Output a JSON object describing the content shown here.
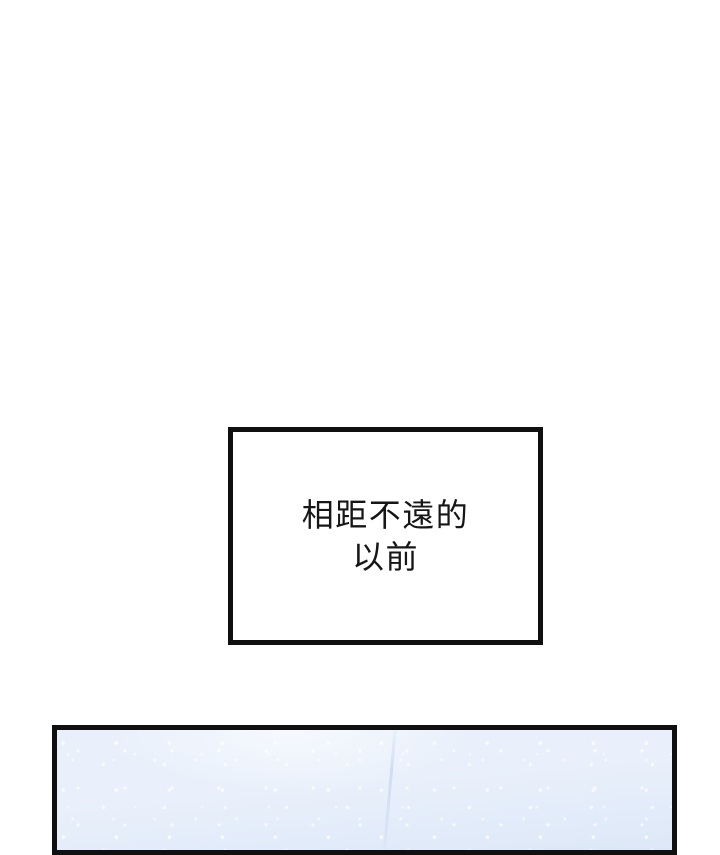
{
  "page": {
    "background_color": "#ffffff"
  },
  "caption_panel": {
    "lines": {
      "line1": "相距不遠的",
      "line2": "以前"
    },
    "border_color": "#101010",
    "text_color": "#161616",
    "background_color": "#ffffff"
  },
  "scene_panel": {
    "border_color": "#101010",
    "base_color": "#e9f0fb",
    "highlight_color": "#f6f9fe",
    "shade_color": "#dde8f8",
    "streak_color": "#b9cdec"
  }
}
